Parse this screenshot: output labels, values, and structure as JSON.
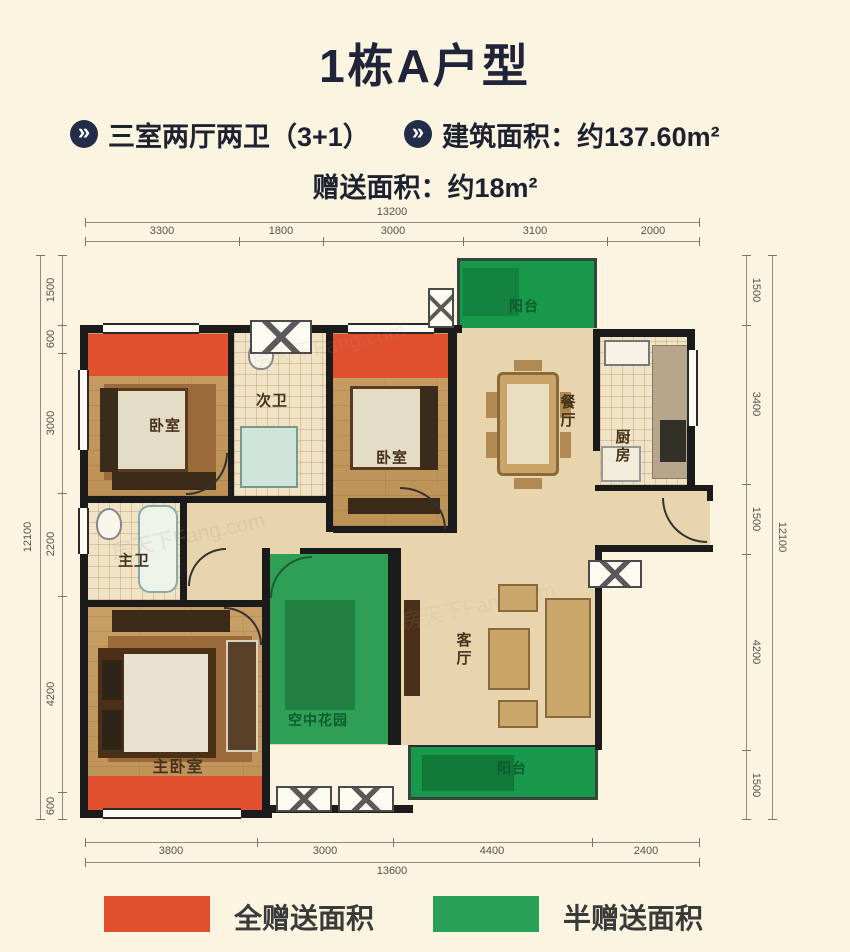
{
  "page": {
    "background_color": "#faf4e0"
  },
  "header": {
    "title": "1栋A户型"
  },
  "features": {
    "item1": {
      "icon": "double-chevron-circle-icon",
      "glyph": "»",
      "text": "三室两厅两卫（3+1）"
    },
    "item2": {
      "icon": "double-chevron-circle-icon",
      "glyph": "»",
      "text": "建筑面积：约137.60m²"
    },
    "bonus": "赠送面积：约18m²"
  },
  "floorplan": {
    "watermark": "房天下Fang.com",
    "rooms": {
      "bedroom1": "卧室",
      "second_bath": "次卫",
      "bedroom2": "卧室",
      "dining": "餐厅",
      "kitchen": "厨房",
      "master_bath": "主卫",
      "master_bedroom": "主卧室",
      "sky_garden": "空中花园",
      "living": "客厅",
      "balcony_top": "阳台",
      "balcony_bottom": "阳台"
    }
  },
  "dimensions": {
    "top": {
      "total": "13200",
      "segments": [
        "3300",
        "1800",
        "3000",
        "3100",
        "2000"
      ]
    },
    "bottom": {
      "total": "13600",
      "segments": [
        "3800",
        "3000",
        "4400",
        "2400"
      ]
    },
    "left": {
      "total": "12100",
      "segments": [
        "1500",
        "600",
        "3000",
        "2200",
        "4200",
        "600"
      ]
    },
    "right": {
      "total": "12100",
      "segments": [
        "1500",
        "3400",
        "1500",
        "4200",
        "1500"
      ]
    }
  },
  "legend": {
    "full_bonus": {
      "color": "#e1502e",
      "label": "全赠送面积"
    },
    "half_bonus": {
      "color": "#28a157",
      "label": "半赠送面积"
    }
  },
  "colors": {
    "accent_red": "#e1502e",
    "accent_green": "#28a157",
    "icon_navy": "#232c48",
    "wall": "#1b1b1b"
  }
}
